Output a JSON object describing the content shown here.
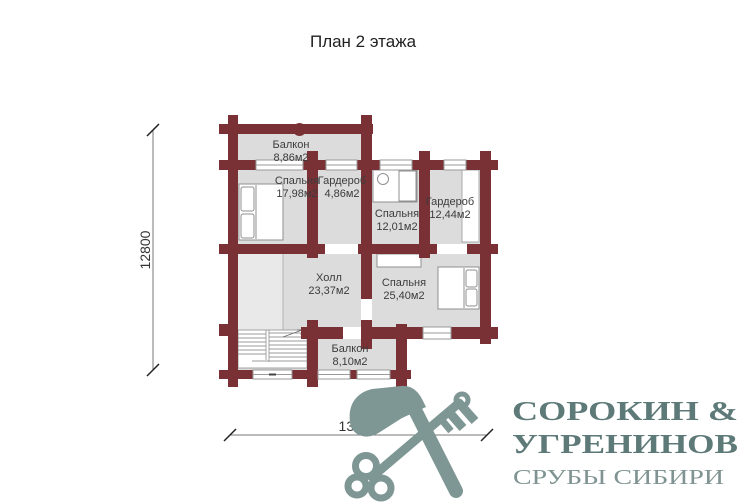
{
  "title": "План 2 этажа",
  "plan": {
    "rooms": [
      {
        "id": "balcony-top",
        "name": "Балкон",
        "area": "8,86м2"
      },
      {
        "id": "bedroom-1",
        "name": "Спальня",
        "area": "17,98м2"
      },
      {
        "id": "wardrobe-1",
        "name": "Гардероб",
        "area": "4,86м2"
      },
      {
        "id": "bedroom-2",
        "name": "Спальня",
        "area": "12,01м2"
      },
      {
        "id": "wardrobe-2",
        "name": "Гардероб",
        "area": "12,44м2"
      },
      {
        "id": "hall",
        "name": "Холл",
        "area": "23,37м2"
      },
      {
        "id": "bedroom-3",
        "name": "Спальня",
        "area": "25,40м2"
      },
      {
        "id": "balcony-bottom",
        "name": "Балкон",
        "area": "8,10м2"
      }
    ],
    "dimensions": {
      "vertical": "12800",
      "horizontal": "13500"
    },
    "colors": {
      "wall": "#7a3135",
      "floor": "#dcdcdd",
      "void": "#e9e9ea"
    }
  },
  "logo": {
    "line1": "СОРОКИН &",
    "line2": "УГРЕНИНОВ",
    "line3": "СРУБЫ СИБИРИ",
    "text_color": "#5e7a78",
    "sub_color": "#7f9492",
    "icon_color": "#7e9794",
    "icon": "crossed-axe-and-key"
  }
}
